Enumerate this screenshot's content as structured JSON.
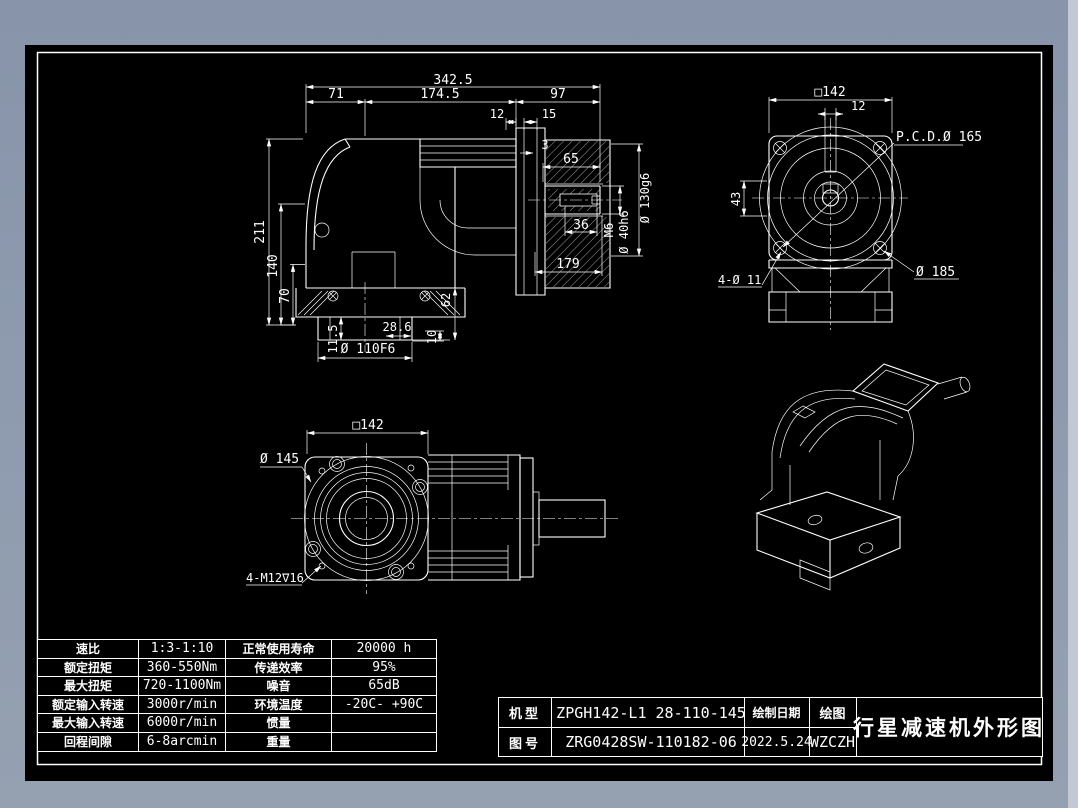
{
  "colors": {
    "canvas": "#000000",
    "line": "#ffffff",
    "frame": "#8d9aae"
  },
  "front_view": {
    "dim_total_width": "342.5",
    "dim_seg_left": "71",
    "dim_seg_mid": "174.5",
    "dim_seg_right": "97",
    "dim_step1": "12",
    "dim_step2": "15",
    "dim_height": "211",
    "dim_h140": "140",
    "dim_h70": "70",
    "dim_gap": "3",
    "dim_shaft_len": "65",
    "dim_key_len": "36",
    "dim_tap": "M6",
    "dim_shaft_dia": "Ø 40h6",
    "dim_pilot_dia": "Ø 130g6",
    "dim_block_len": "179",
    "dim_foot_offset": "11.5",
    "dim_key_w": "28.6",
    "dim_bottom_pilot": "Ø 110F6",
    "dim_plate": "10",
    "dim_foot_h": "62"
  },
  "rear_view": {
    "dim_square": "□142",
    "dim_keyway": "12",
    "dim_pcd": "P.C.D.Ø 165",
    "dim_43": "43",
    "dim_flange": "Ø 185",
    "dim_holes": "4-Ø 11"
  },
  "face_view": {
    "dim_square": "□142",
    "dim_flange_dia": "Ø 145",
    "dim_holes": "4-M12∇16"
  },
  "spec_table": {
    "rows": [
      [
        "速比",
        "1:3-1:10",
        "正常使用寿命",
        "20000 h"
      ],
      [
        "额定扭矩",
        "360-550Nm",
        "传递效率",
        "95%"
      ],
      [
        "最大扭矩",
        "720-1100Nm",
        "噪音",
        "65dB"
      ],
      [
        "额定输入转速",
        "3000r/min",
        "环境温度",
        "-20C- +90C"
      ],
      [
        "最大输入转速",
        "6000r/min",
        "惯量",
        ""
      ],
      [
        "回程间隙",
        "6-8arcmin",
        "重量",
        ""
      ]
    ]
  },
  "title_block": {
    "model_label": "机型",
    "model_value": "ZPGH142-L1 28-110-145",
    "number_label": "图号",
    "number_value": "ZRG0428SW-110182-06",
    "date_label": "绘制日期",
    "date_value": "2022.5.24",
    "author_label": "绘图",
    "author_value": "WZCZH",
    "title": "行星减速机外形图"
  }
}
